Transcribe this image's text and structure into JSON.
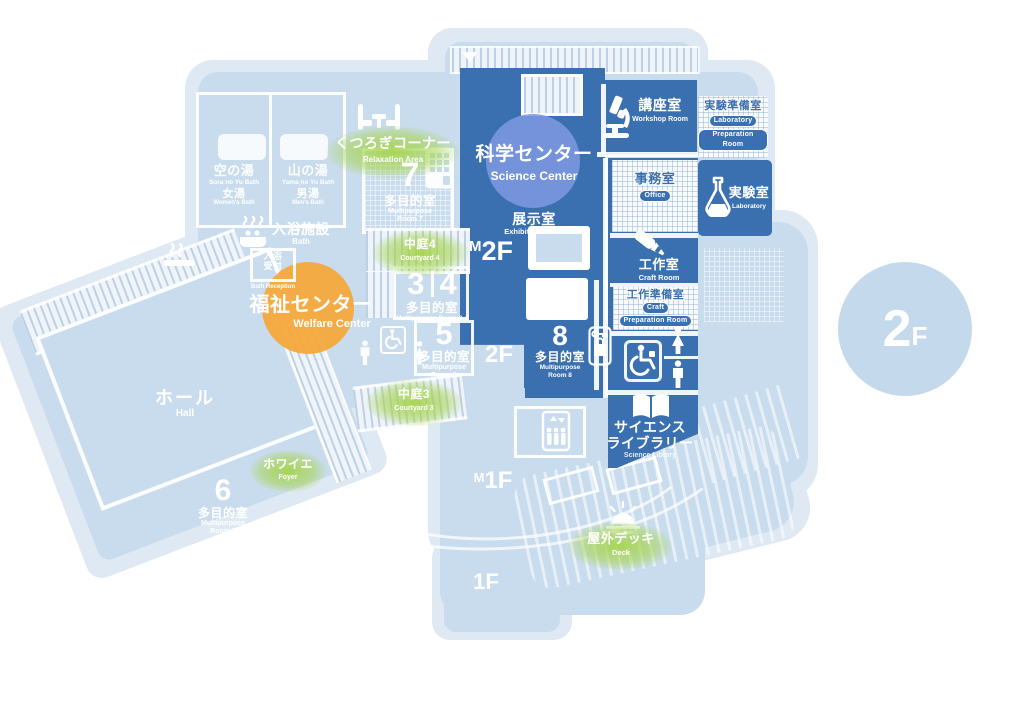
{
  "floor_badge": {
    "num": "2",
    "f": "F"
  },
  "floor_markers": {
    "m2f": {
      "m": "M",
      "f": "2F"
    },
    "f2": "2F",
    "m1f": {
      "m": "M",
      "f": "1F"
    },
    "f1": "1F"
  },
  "centers": {
    "science": {
      "jp": "科学センター",
      "en": "Science Center"
    },
    "welfare": {
      "jp": "福祉センター",
      "en": "Welfare Center"
    }
  },
  "rooms": {
    "sora_no_yu": {
      "jp": "空の湯",
      "en": "Sora no Yu Bath",
      "sub_jp": "女湯",
      "sub_en": "Women's Bath"
    },
    "yama_no_yu": {
      "jp": "山の湯",
      "en": "Yama no Yu Bath",
      "sub_jp": "男湯",
      "sub_en": "Men's Bath"
    },
    "bath": {
      "jp": "入浴施設",
      "en": "Bath"
    },
    "bath_reception": {
      "jp1": "入浴",
      "jp2": "受付",
      "en": "Bath Reception"
    },
    "relaxation": {
      "jp": "くつろぎコーナー",
      "en": "Relaxation Area"
    },
    "room7": {
      "num": "7",
      "jp": "多目的室",
      "en1": "Multipurpose",
      "en2": "Room 7"
    },
    "courtyard4": {
      "jp": "中庭4",
      "en": "Courtyard 4"
    },
    "room34": {
      "num1": "3",
      "num2": "4",
      "jp": "多目的室",
      "en": "Multipurpose Room 3,4"
    },
    "room5": {
      "num": "5",
      "jp": "多目的室",
      "en1": "Multipurpose",
      "en2": "Room 5"
    },
    "courtyard3": {
      "jp": "中庭3",
      "en": "Courtyard 3"
    },
    "hall": {
      "jp": "ホール",
      "en": "Hall"
    },
    "foyer": {
      "jp": "ホワイエ",
      "en": "Foyer"
    },
    "room6": {
      "num": "6",
      "jp": "多目的室",
      "en1": "Multipurpose",
      "en2": "Room 6"
    },
    "deck": {
      "jp": "屋外デッキ",
      "en": "Deck"
    },
    "exhibition": {
      "jp": "展示室",
      "en": "Exhibition Room"
    },
    "workshop": {
      "jp": "講座室",
      "en": "Workshop Room"
    },
    "lab_prep": {
      "jp": "実験準備室",
      "en1": "Laboratory",
      "en2": "Preparation Room"
    },
    "laboratory": {
      "jp": "実験室",
      "en": "Laboratory"
    },
    "office": {
      "jp": "事務室",
      "en": "Office"
    },
    "craft": {
      "jp": "工作室",
      "en": "Craft Room"
    },
    "craft_prep": {
      "jp": "工作準備室",
      "en1": "Craft",
      "en2": "Preparation Room"
    },
    "room8": {
      "num": "8",
      "jp": "多目的室",
      "en1": "Multipurpose",
      "en2": "Room 8"
    },
    "science_library": {
      "jp1": "サイエンス",
      "jp2": "ライブラリー",
      "en": "Science Library"
    }
  },
  "icons": {
    "relaxation_seats": "facing-seats",
    "bath_tub": "steaming-bathtub",
    "smoking": "smoking-area",
    "elevator_panel": "elevator-panel",
    "elevator": "elevator",
    "microscope": "microscope",
    "flask": "laboratory-flask",
    "craft_knife": "craft-knife",
    "locker_key": "locker-key",
    "accessible_toilet": "wheelchair",
    "women_toilet": "woman-pictogram",
    "men_toilet": "man-pictogram",
    "open_book": "open-book",
    "sun_deck": "sun-over-deck"
  },
  "colors": {
    "silhouette": "#dfe9f4",
    "body": "#c9dcee",
    "primary": "#3a6fb0",
    "accent_green": "#a6d44f",
    "accent_orange": "#f5a93d",
    "accent_periwinkle": "#7d98e0",
    "badge_circle": "#c5d9ec",
    "wall": "#ffffff"
  }
}
